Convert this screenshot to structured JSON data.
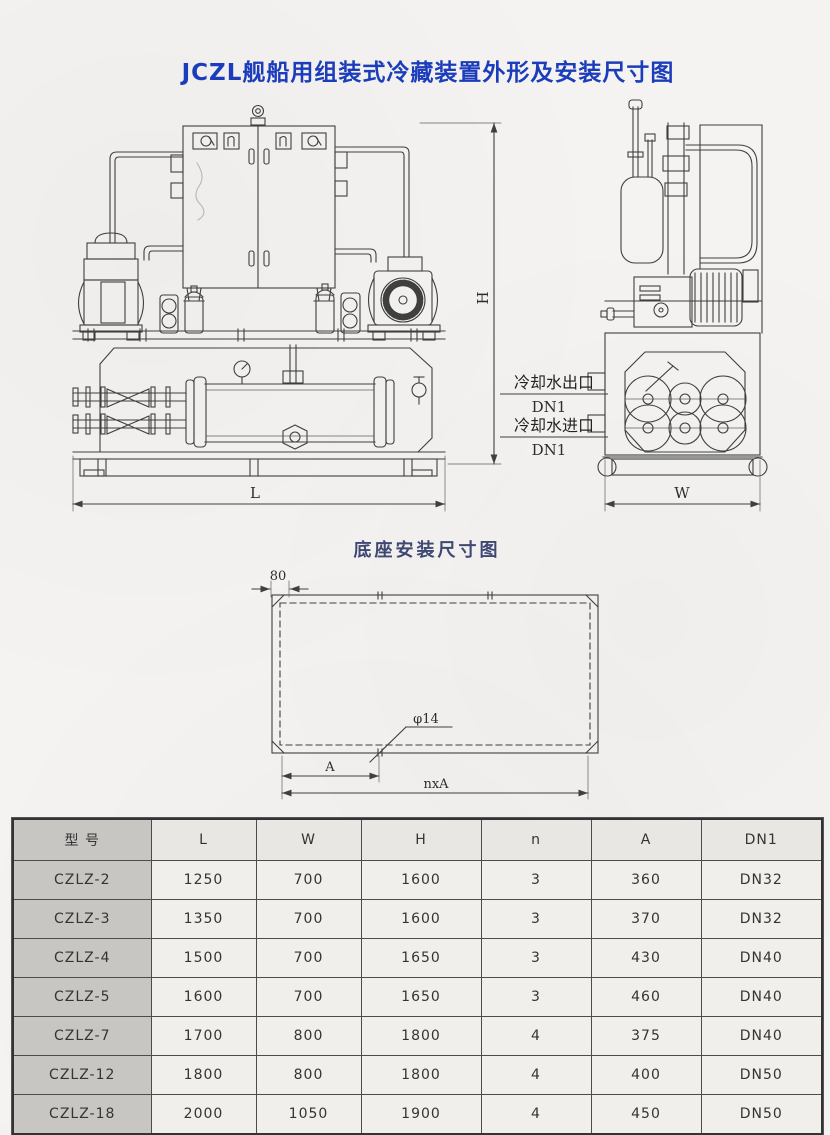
{
  "page": {
    "title": "JCZL舰船用组装式冷藏装置外形及安装尺寸图"
  },
  "outline_drawing": {
    "dim_h_label": "H",
    "dim_l_label": "L",
    "dim_w_label": "W",
    "cooling_water_outlet_label": "冷却水出口",
    "cooling_water_outlet_size": "DN1",
    "cooling_water_inlet_label": "冷却水进口",
    "cooling_water_inlet_size": "DN1"
  },
  "base_diagram": {
    "title": "底座安装尺寸图",
    "edge_dim_label": "80",
    "hole_dia_label": "φ14",
    "pitch_dim_label": "A",
    "total_pitch_dim_label": "nxA"
  },
  "spec_table": {
    "headers": [
      "型 号",
      "L",
      "W",
      "H",
      "n",
      "A",
      "DN1"
    ],
    "rows": [
      [
        "CZLZ-2",
        "1250",
        "700",
        "1600",
        "3",
        "360",
        "DN32"
      ],
      [
        "CZLZ-3",
        "1350",
        "700",
        "1600",
        "3",
        "370",
        "DN32"
      ],
      [
        "CZLZ-4",
        "1500",
        "700",
        "1650",
        "3",
        "430",
        "DN40"
      ],
      [
        "CZLZ-5",
        "1600",
        "700",
        "1650",
        "3",
        "460",
        "DN40"
      ],
      [
        "CZLZ-7",
        "1700",
        "800",
        "1800",
        "4",
        "375",
        "DN40"
      ],
      [
        "CZLZ-12",
        "1800",
        "800",
        "1800",
        "4",
        "400",
        "DN50"
      ],
      [
        "CZLZ-18",
        "2000",
        "1050",
        "1900",
        "4",
        "450",
        "DN50"
      ]
    ]
  },
  "colors": {
    "title_blue": "#1c3dbb",
    "subtitle_blue": "#3e4873",
    "line_color": "#3f3f3f"
  }
}
